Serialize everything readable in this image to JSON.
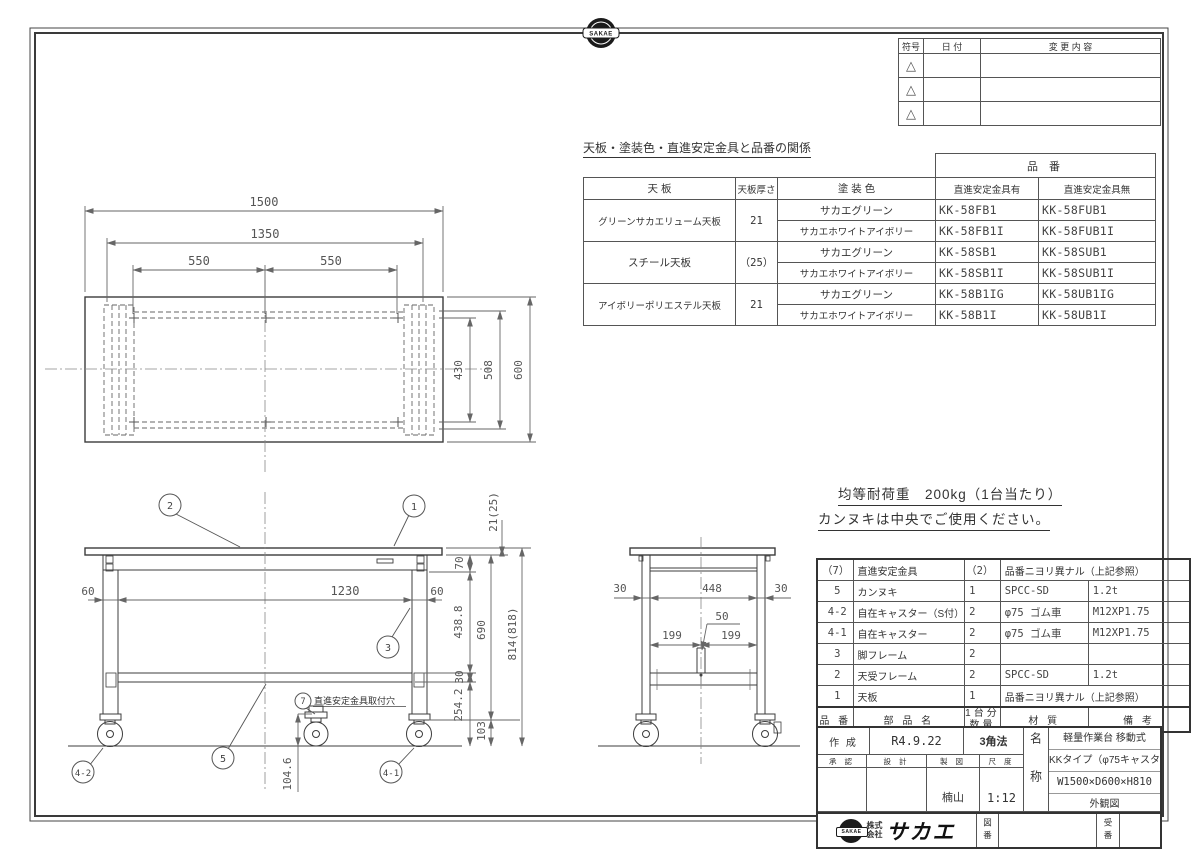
{
  "sheet": {
    "badge": "SAKAE"
  },
  "revision_table": {
    "col_symbol": "符号",
    "col_date": "日 付",
    "col_change": "変 更 内 容",
    "rows": [
      "△",
      "△",
      "△"
    ]
  },
  "parts_table": {
    "title": "天板・塗装色・直進安定金具と品番の関係",
    "part_no_header": "品 番",
    "col_top": "天 板",
    "col_thickness": "天板厚さ",
    "col_color": "塗 装 色",
    "col_with": "直進安定金具有",
    "col_without": "直進安定金具無",
    "groups": [
      {
        "top": "グリーンサカエリューム天板",
        "thickness": "21",
        "rows": [
          {
            "color": "サカエグリーン",
            "with_no": "KK-58FB1",
            "without_no": "KK-58FUB1"
          },
          {
            "color": "サカエホワイトアイボリー",
            "with_no": "KK-58FB1I",
            "without_no": "KK-58FUB1I"
          }
        ]
      },
      {
        "top": "スチール天板",
        "thickness": "（25）",
        "rows": [
          {
            "color": "サカエグリーン",
            "with_no": "KK-58SB1",
            "without_no": "KK-58SUB1"
          },
          {
            "color": "サカエホワイトアイボリー",
            "with_no": "KK-58SB1I",
            "without_no": "KK-58SUB1I"
          }
        ]
      },
      {
        "top": "アイボリーポリエステル天板",
        "thickness": "21",
        "rows": [
          {
            "color": "サカエグリーン",
            "with_no": "KK-58B1IG",
            "without_no": "KK-58UB1IG"
          },
          {
            "color": "サカエホワイトアイボリー",
            "with_no": "KK-58B1I",
            "without_no": "KK-58UB1I"
          }
        ]
      }
    ]
  },
  "notes": {
    "load": "均等耐荷重　200kg（1台当たり）",
    "usage": "カンヌキは中央でご使用ください。"
  },
  "bom_table": {
    "col_no": "品 番",
    "col_name": "部 品 名",
    "col_qty_1": "1台分",
    "col_qty_2": "数量",
    "col_material": "材 質",
    "col_remarks": "備 考",
    "rows": [
      {
        "no": "（7）",
        "name": "直進安定金具",
        "qty": "（2）",
        "note": "品番ニヨリ異ナル（上記参照）"
      },
      {
        "no": "5",
        "name": "カンヌキ",
        "qty": "1",
        "material": "SPCC-SD",
        "remarks": "1.2t"
      },
      {
        "no": "4-2",
        "name": "自在キャスター（S付）",
        "qty": "2",
        "material": "φ75 ゴム車",
        "remarks": "M12XP1.75"
      },
      {
        "no": "4-1",
        "name": "自在キャスター",
        "qty": "2",
        "material": "φ75 ゴム車",
        "remarks": "M12XP1.75"
      },
      {
        "no": "3",
        "name": "脚フレーム",
        "qty": "2",
        "material": "",
        "remarks": ""
      },
      {
        "no": "2",
        "name": "天受フレーム",
        "qty": "2",
        "material": "SPCC-SD",
        "remarks": "1.2t"
      },
      {
        "no": "1",
        "name": "天板",
        "qty": "1",
        "note": "品番ニヨリ異ナル（上記参照）"
      }
    ]
  },
  "title_block": {
    "created_label": "作 成",
    "created_value": "R4.9.22",
    "projection": "3角法",
    "approve_label": "承 認",
    "design_label": "設 計",
    "draft_label": "製 図",
    "scale_label": "尺 度",
    "drafter": "楠山",
    "scale": "1:12",
    "name_label": "名称",
    "product_line1": "軽量作業台 移動式",
    "product_line2": "KKタイプ（φ75キャスター）",
    "product_line3": "W1500×D600×H810",
    "product_line4": "外観図",
    "company_prefix1": "株式",
    "company_prefix2": "会社",
    "company_name": "サカエ",
    "drawing_no_label": "図番",
    "order_no_label": "受番"
  },
  "views": {
    "top": {
      "d1500": "1500",
      "d1350": "1350",
      "d550a": "550",
      "d550b": "550",
      "d430": "430",
      "d508": "508",
      "d600": "600"
    },
    "front": {
      "d21": "21(25)",
      "d70": "70",
      "d60l": "60",
      "d1230": "1230",
      "d60r": "60",
      "d438": "438.8",
      "d690": "690",
      "d30": "30",
      "d254": "254.2",
      "d103": "103",
      "d814": "814(818)",
      "d104": "104.6",
      "b1": "1",
      "b2": "2",
      "b3": "3",
      "b5": "5",
      "b7": "7",
      "b41": "4-1",
      "b42": "4-2",
      "note7": "直進安定金具取付穴"
    },
    "side": {
      "d30l": "30",
      "d448": "448",
      "d30r": "30",
      "d199l": "199",
      "d199r": "199",
      "d50": "50"
    }
  }
}
